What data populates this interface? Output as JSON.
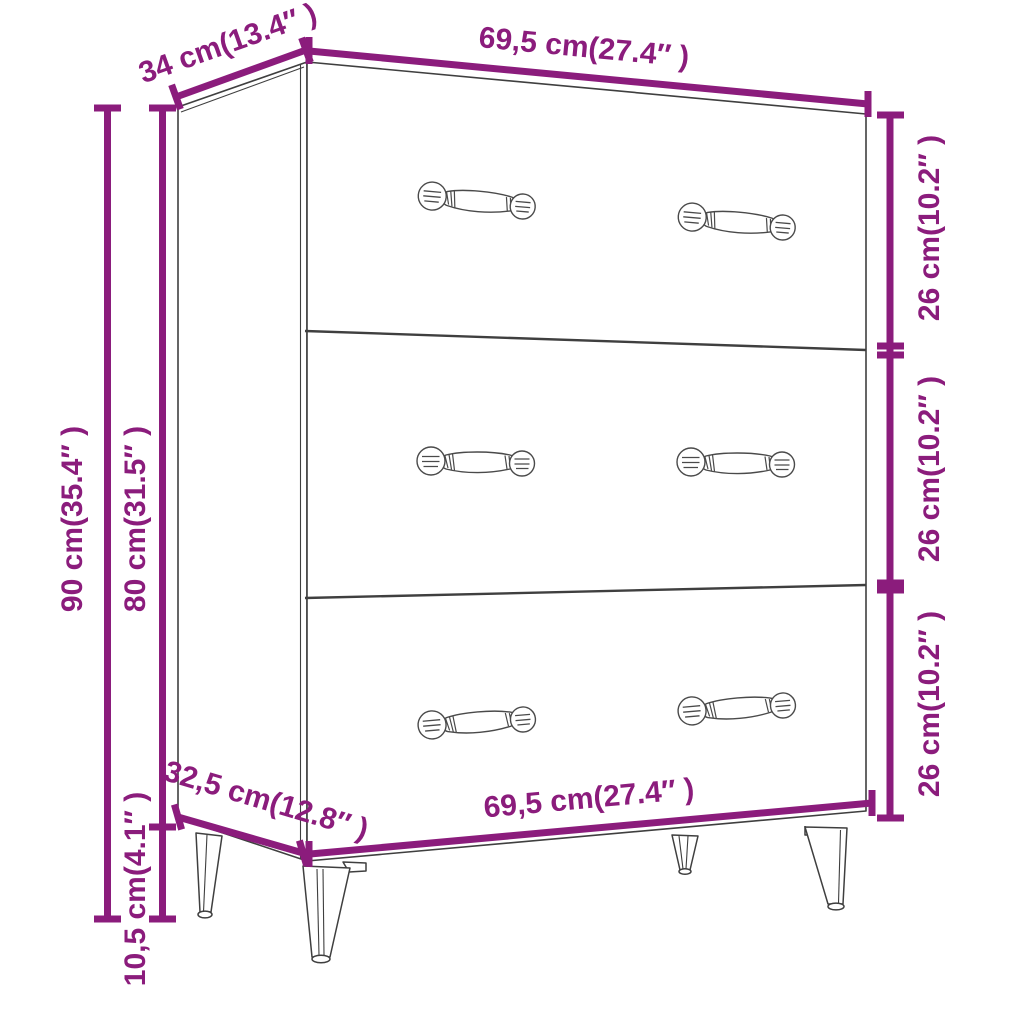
{
  "diagram": {
    "object": "sideboard-with-3-drawers",
    "accent_color": "#8B1C7C",
    "outline_color": "#3F3F3F",
    "background_color": "#FFFFFF",
    "labels": {
      "top_depth": "34 cm(13.4″ )",
      "top_width": "69,5 cm(27.4″ )",
      "drawer_heights": [
        "26 cm(10.2″ )",
        "26 cm(10.2″ )",
        "26 cm(10.2″ )"
      ],
      "total_height": "90 cm(35.4″ )",
      "body_height": "80 cm(31.5″ )",
      "leg_height": "10,5 cm(4.1″ )",
      "bottom_depth": "32,5 cm(12.8″ )",
      "bottom_width": "69,5 cm(27.4″ )"
    }
  }
}
